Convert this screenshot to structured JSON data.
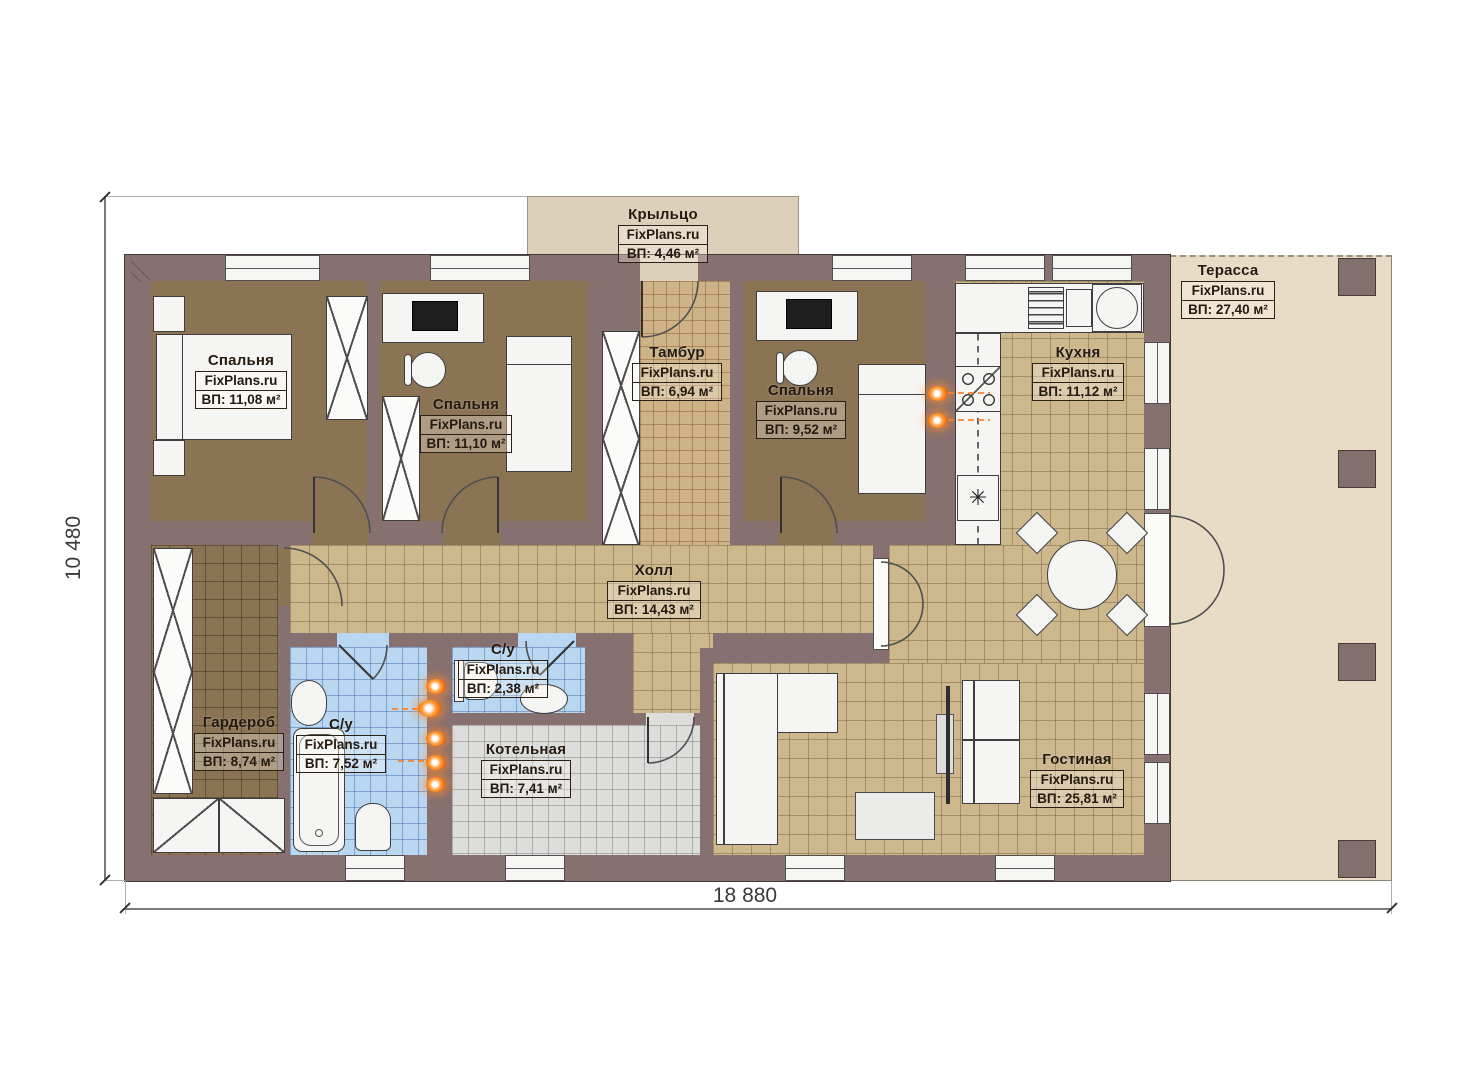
{
  "plan": {
    "title": "Одноэтажный дом — план этажа",
    "dimensions": {
      "height_label": "10 480",
      "width_label": "18 880"
    },
    "rooms": {
      "porch": {
        "name": "Крыльцо",
        "brand": "FixPlans.ru",
        "area": "ВП: 4,46 м²"
      },
      "bedroom1": {
        "name": "Спальня",
        "brand": "FixPlans.ru",
        "area": "ВП: 11,08 м²"
      },
      "bedroom2": {
        "name": "Спальня",
        "brand": "FixPlans.ru",
        "area": "ВП: 11,10 м²"
      },
      "tambour": {
        "name": "Тамбур",
        "brand": "FixPlans.ru",
        "area": "ВП: 6,94 м²"
      },
      "bedroom3": {
        "name": "Спальня",
        "brand": "FixPlans.ru",
        "area": "ВП: 9,52 м²"
      },
      "kitchen": {
        "name": "Кухня",
        "brand": "FixPlans.ru",
        "area": "ВП: 11,12 м²"
      },
      "terrace": {
        "name": "Терасса",
        "brand": "FixPlans.ru",
        "area": "ВП: 27,40 м²"
      },
      "hall": {
        "name": "Холл",
        "brand": "FixPlans.ru",
        "area": "ВП: 14,43 м²"
      },
      "wardrobe": {
        "name": "Гардероб",
        "brand": "FixPlans.ru",
        "area": "ВП: 8,74 м²"
      },
      "bathroom_main": {
        "name": "С/у",
        "brand": "FixPlans.ru",
        "area": "ВП: 7,52 м²"
      },
      "bathroom_small": {
        "name": "С/у",
        "brand": "FixPlans.ru",
        "area": "ВП: 2,38 м²"
      },
      "boiler": {
        "name": "Котельная",
        "brand": "FixPlans.ru",
        "area": "ВП: 7,41 м²"
      },
      "living": {
        "name": "Гостиная",
        "brand": "FixPlans.ru",
        "area": "ВП: 25,81 м²"
      }
    },
    "colors": {
      "wall": "#877070",
      "floor_beige_tile": "#cdb88e",
      "floor_blue_tile": "#bad7f2",
      "floor_gray_tile": "#dddddb",
      "floor_brown": "#8b7454",
      "terrace": "#e8dcc7",
      "heat_marker_orange": "#f97e2a"
    }
  }
}
